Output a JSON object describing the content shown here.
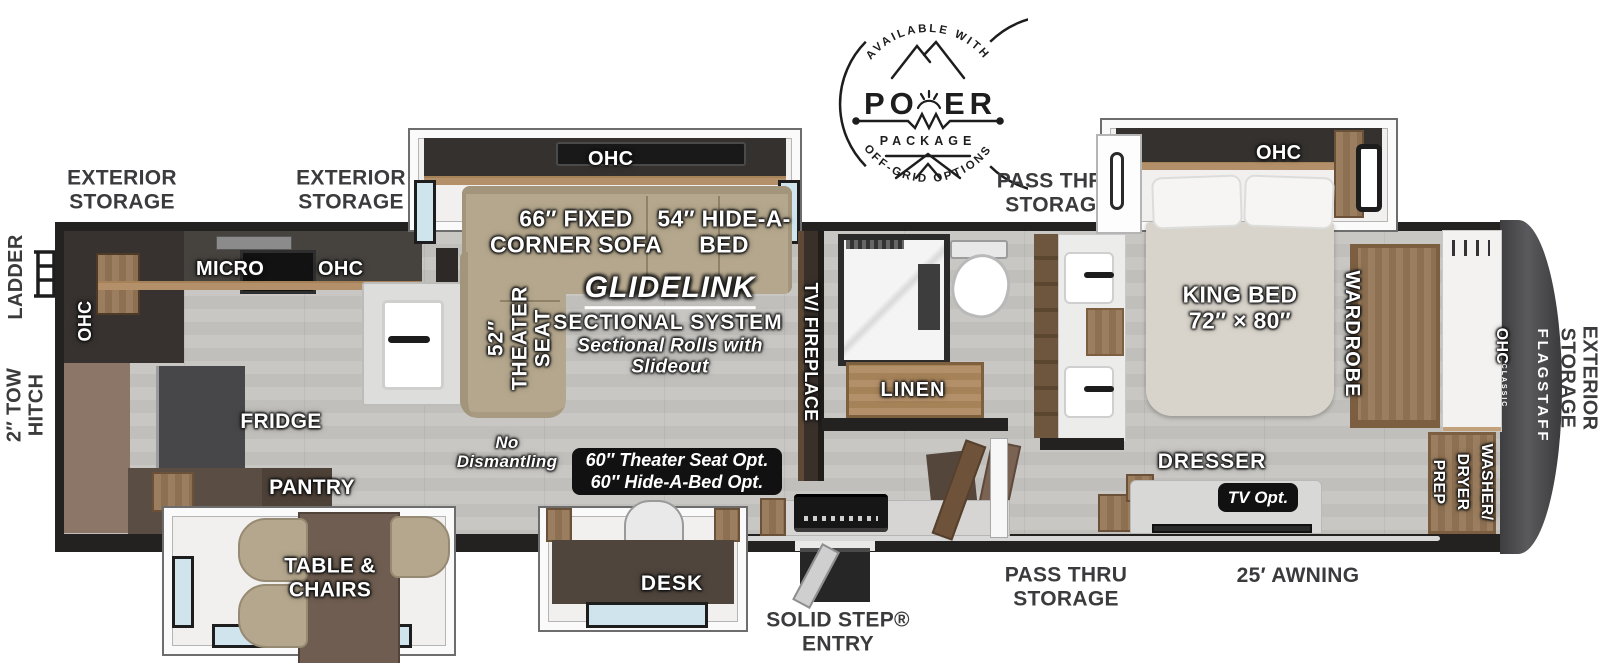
{
  "badge": {
    "arc_top": "AVAILABLE WITH",
    "word": "PO",
    "word2": "ER",
    "word_sub": "PACKAGE",
    "arc_bottom": "OFF-GRID OPTIONS"
  },
  "exterior": {
    "storage_front_1": "EXTERIOR\nSTORAGE",
    "storage_front_2": "EXTERIOR\nSTORAGE",
    "pass_thru_top": "PASS THRU\nSTORAGE",
    "pass_thru_bottom": "PASS THRU\nSTORAGE",
    "awning": "25′ AWNING",
    "solid_step": "SOLID STEP®\nENTRY",
    "ladder": "LADDER",
    "tow_hitch": "2″ TOW\nHITCH",
    "storage_rear": "EXTERIOR\nSTORAGE",
    "brand": "FLAGSTAFF",
    "brand_sub": "CLASSIC"
  },
  "kitchen": {
    "micro": "MICRO",
    "ohc_counter": "OHC",
    "ohc_wall": "OHC",
    "fridge": "FRIDGE",
    "pantry": "PANTRY",
    "table_chairs": "TABLE &\nCHAIRS"
  },
  "living": {
    "ohc": "OHC",
    "corner_sofa": "66″ FIXED\nCORNER SOFA",
    "hide_a_bed": "54″ HIDE-A-\nBED",
    "theater_seat": "52″\nTHEATER\nSEAT",
    "glidelink": "GLIDELINK",
    "sectional_system": "SECTIONAL SYSTEM",
    "sectional_note": "Sectional Rolls with\nSlideout",
    "no_dismantling": "No\nDismantling",
    "options": "60″ Theater Seat Opt.\n60″ Hide-A-Bed Opt.",
    "desk": "DESK",
    "tv_fireplace": "TV/ FIREPLACE"
  },
  "bath": {
    "linen": "LINEN"
  },
  "bedroom": {
    "ohc": "OHC",
    "king_bed": "KING BED\n72″ × 80″",
    "wardrobe": "WARDROBE",
    "dresser": "DRESSER",
    "tv_opt": "TV Opt.",
    "ohc_front": "OHC",
    "washer_dryer": "WASHER/\nDRYER\nPREP"
  }
}
